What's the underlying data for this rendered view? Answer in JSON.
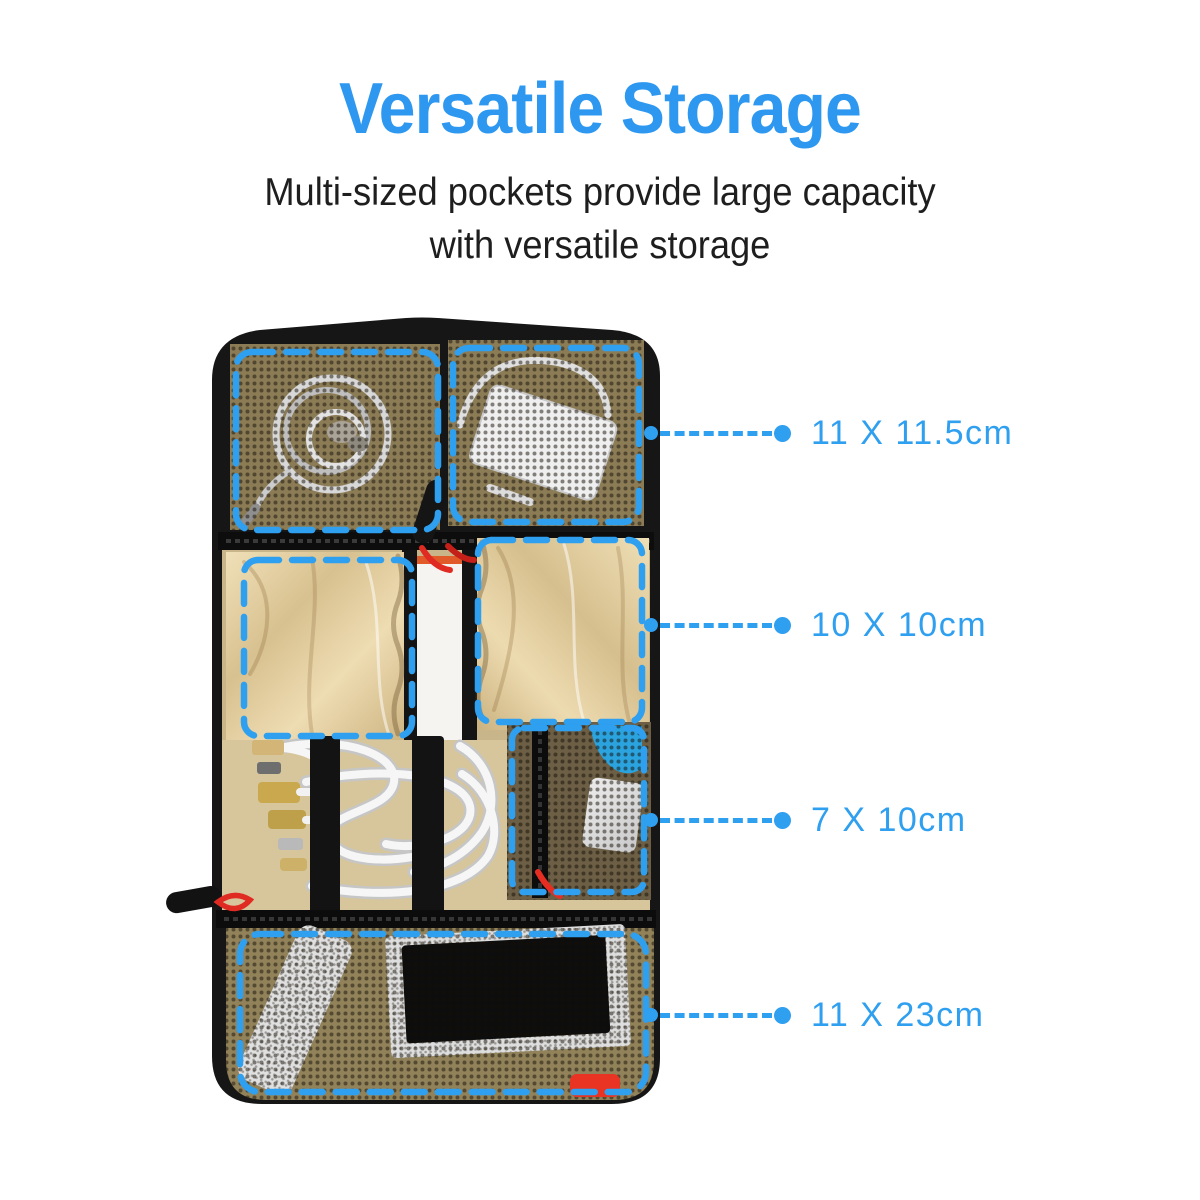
{
  "header": {
    "title": "Versatile Storage",
    "subtitle_lines": [
      "Multi-sized pockets provide large capacity",
      "with versatile storage"
    ]
  },
  "callouts": [
    {
      "label": "11 X 11.5cm"
    },
    {
      "label": "10 X 10cm"
    },
    {
      "label": "7 X 10cm"
    },
    {
      "label": "11 X 23cm"
    }
  ],
  "colors": {
    "title_blue": "#2e98f0",
    "accent_blue": "#2f9ff0",
    "subtitle_dark": "#1e1e1e",
    "bag_shell_black": "#161616",
    "mesh_khaki": "#8c7c56",
    "mesh_khaki_bottom": "#92825a",
    "mesh_dark_pocket": "#6c5f45",
    "satin_beige": "#e6d3a6",
    "tan_cable_area": "#d7c69b",
    "white_item": "#f6f4f0",
    "orange_trim": "#e05a2a",
    "zipper_pull_red": "#e02b22",
    "brand_tab_red": "#e93323",
    "blue_item": "#2ba3de"
  }
}
